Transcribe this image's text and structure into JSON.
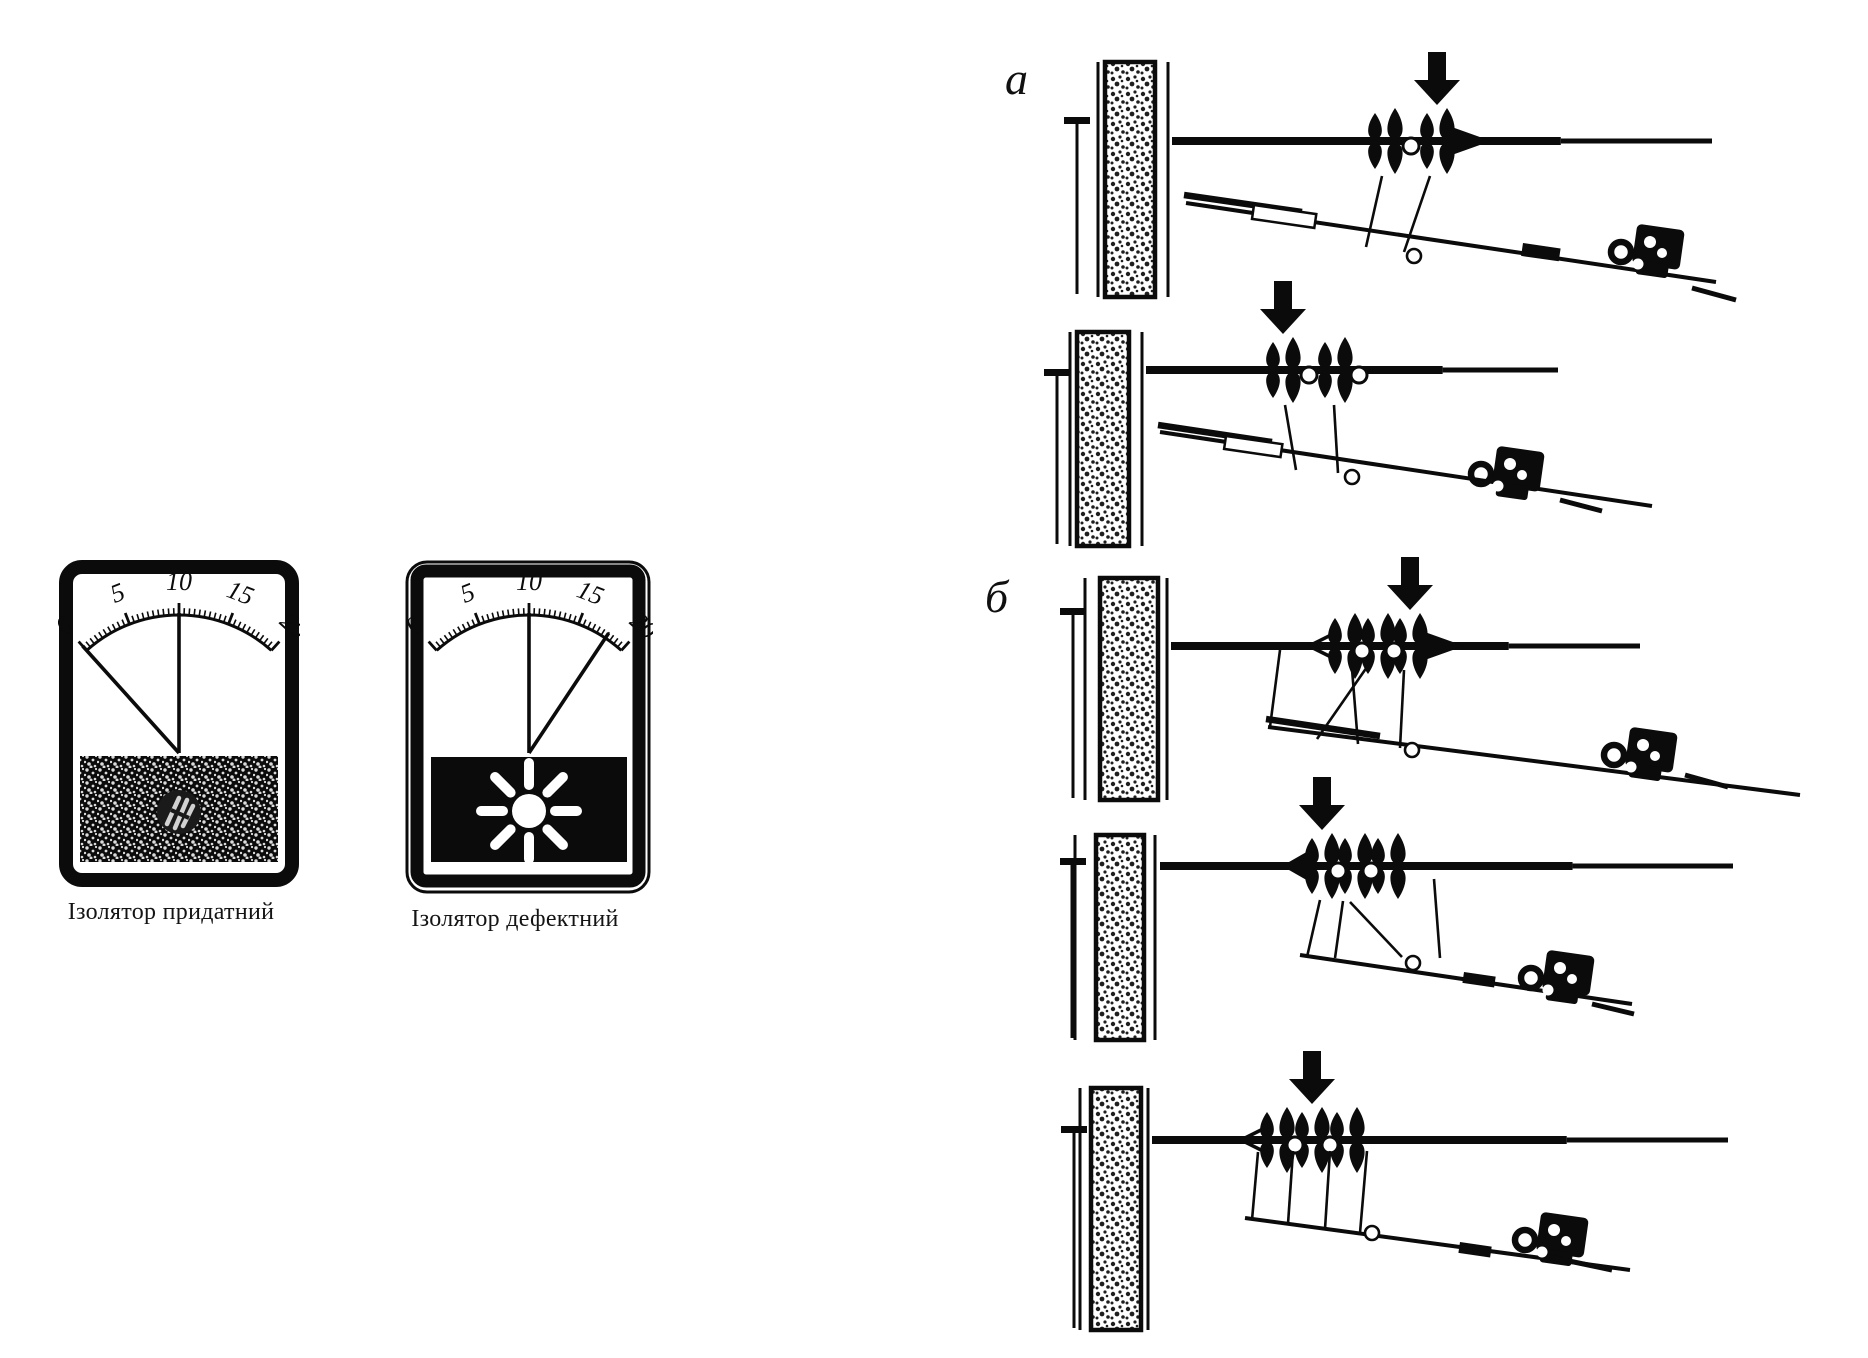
{
  "figure": {
    "ink": "#0b0b0b",
    "paper": "#ffffff",
    "meters": [
      {
        "label": "Ізолятор придатний",
        "scale_ticks": [
          "0",
          "5",
          "10",
          "15",
          "20"
        ],
        "scale_min": 0,
        "scale_max": 20,
        "needle_value": 0,
        "reference_value": 10,
        "lamp": "off"
      },
      {
        "label": "Ізолятор дефектний",
        "scale_ticks": [
          "0",
          "5",
          "10",
          "15",
          "20"
        ],
        "scale_min": 0,
        "scale_max": 20,
        "needle_value": 18,
        "reference_value": 10,
        "lamp": "on"
      }
    ],
    "sections": [
      {
        "label": "а",
        "rows": [
          {
            "insulators": 2,
            "arrow_on": 2
          },
          {
            "insulators": 2,
            "arrow_on": 1
          }
        ]
      },
      {
        "label": "б",
        "rows": [
          {
            "insulators": 3,
            "arrow_on": 3
          },
          {
            "insulators": 3,
            "arrow_on": 1
          },
          {
            "insulators": 3,
            "arrow_on": 2
          }
        ]
      }
    ]
  }
}
